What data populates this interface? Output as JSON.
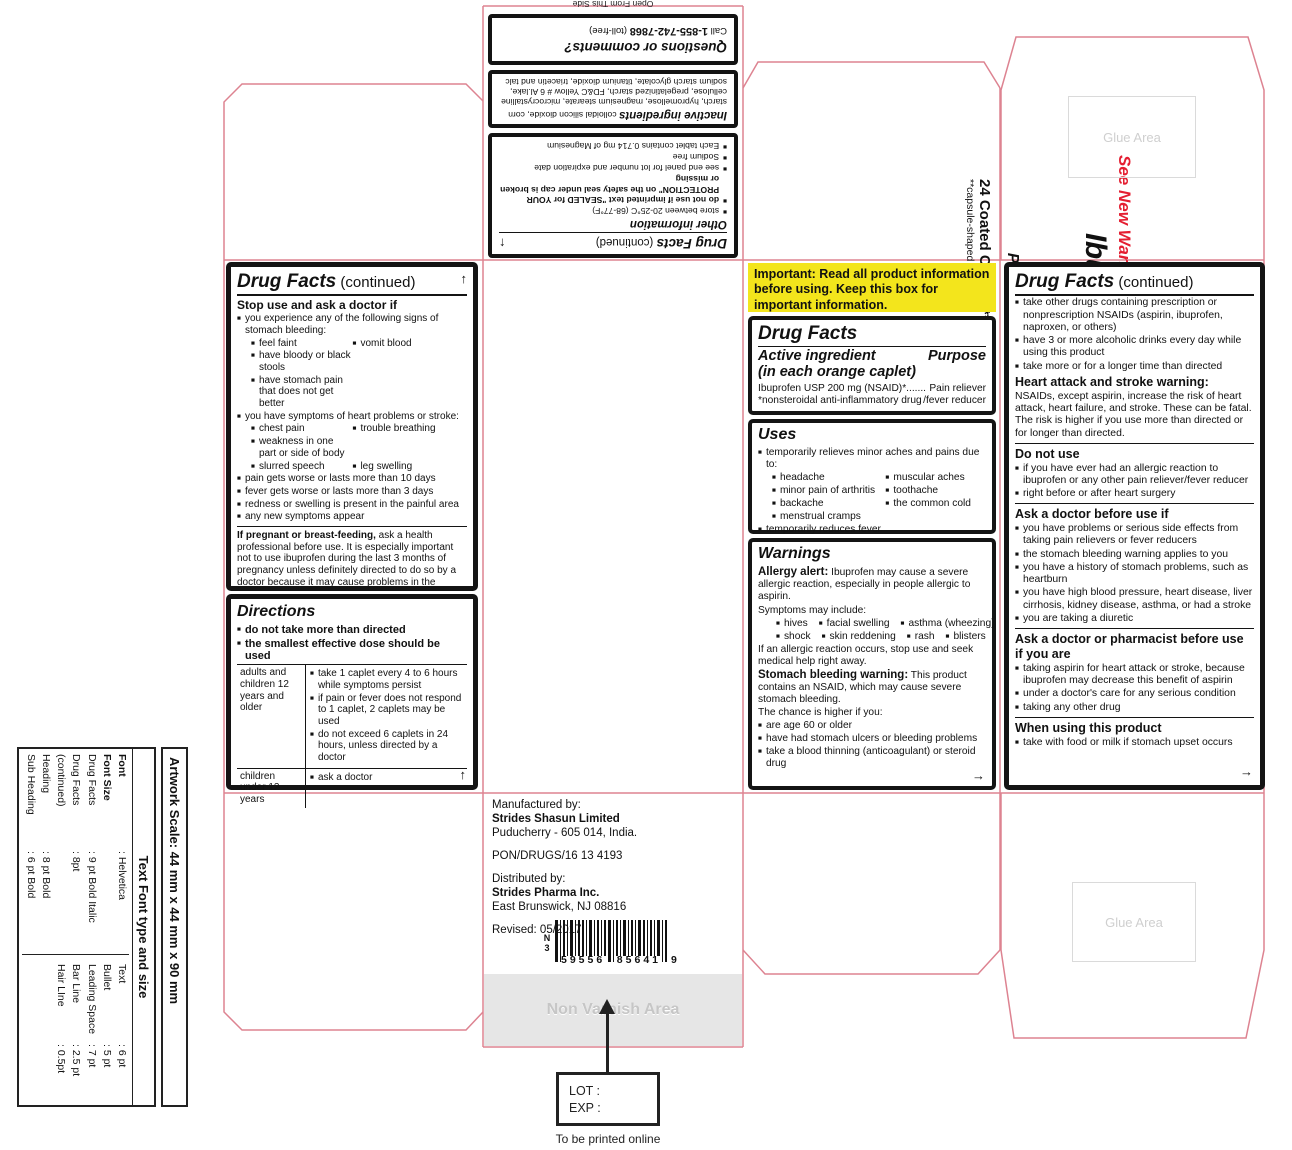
{
  "icons": {
    "up_arrow": "↑",
    "right_arrow": "→"
  },
  "colors": {
    "dieline": "#dd8391",
    "yellow": "#f3e51c",
    "orange": "#f08019",
    "red": "#e41e31"
  },
  "misc": {
    "open_from": "Open From This Side",
    "glue_area": "Glue Area",
    "non_varnish": "Non Varnish Area",
    "lot_label": "LOT :",
    "exp_label": "EXP :",
    "to_be_printed": "To be printed online"
  },
  "top_panel": {
    "dfc_title": "Drug Facts",
    "dfc_cont": " (continued)",
    "other_info": {
      "heading": "Other information",
      "rows": [
        {
          "t": "store between 20-25°C (68-77°F)"
        },
        {
          "b": "do not use if imprinted text \"SEALED for YOUR PROTECTION\" on the safety seal under cap is broken or missing"
        },
        {
          "t": "see end panel for lot number and expiration date"
        },
        {
          "t": "Sodium free"
        },
        {
          "t": "Each tablet contains 0.714 mg of Magnesium"
        }
      ]
    },
    "inactive": {
      "heading": "Inactive ingredients",
      "text": "colloidal silicon dioxide, corn starch, hypromellose, magnesium stearate, microcrystalline cellulose, pregelatinized starch, FD&C Yellow # 6 Al.lake, sodium starch glycolate, titanium dioxide, triacetin and talc"
    },
    "questions": {
      "heading": "Questions or comments?",
      "call_prefix": "Call ",
      "phone": "1-855-742-7868",
      "call_suffix": " (toll-free)"
    }
  },
  "left_panel": {
    "dfc_title": "Drug Facts",
    "dfc_cont": " (continued)",
    "stop_use": {
      "heading": "Stop use and ask a doctor if",
      "rows": [
        {
          "c": [
            {
              "t": "you experience any of the following signs of stomach bleeding:"
            }
          ]
        },
        {
          "i": 1,
          "c": [
            {
              "t": "feel faint"
            },
            {
              "t": "vomit blood"
            }
          ]
        },
        {
          "i": 1,
          "c": [
            {
              "t": "have bloody or black stools"
            }
          ]
        },
        {
          "i": 1,
          "c": [
            {
              "t": "have stomach pain that does not get better"
            }
          ]
        },
        {
          "c": [
            {
              "t": "you have symptoms of heart problems or stroke:"
            }
          ]
        },
        {
          "i": 1,
          "c": [
            {
              "t": "chest pain"
            },
            {
              "t": "trouble breathing"
            }
          ]
        },
        {
          "i": 1,
          "c": [
            {
              "t": "weakness in one part or side of body"
            }
          ]
        },
        {
          "i": 1,
          "c": [
            {
              "t": "slurred speech"
            },
            {
              "t": "leg swelling"
            }
          ]
        },
        {
          "c": [
            {
              "t": "pain gets worse or lasts more than 10 days"
            }
          ]
        },
        {
          "c": [
            {
              "t": "fever gets worse or lasts more than 3 days"
            }
          ]
        },
        {
          "c": [
            {
              "t": "redness or swelling is present in the painful area"
            }
          ]
        },
        {
          "c": [
            {
              "t": "any new symptoms appear"
            }
          ]
        }
      ]
    },
    "pregnant": {
      "b": "If pregnant or breast-feeding,",
      "t": " ask a health professional before use. It is especially important not to use ibuprofen during the last 3 months of pregnancy unless definitely directed to do so by a doctor because it may cause problems in the unborn child or complications during delivery."
    },
    "keep_out": {
      "heading": "Keep out of reach of children.",
      "text": "In case of overdose, get medical help or contact a Poison Control Center right away.(1-800-222-1222)"
    },
    "directions": {
      "heading": "Directions",
      "rows": [
        {
          "c": [
            {
              "b": "do not take more than directed"
            }
          ]
        },
        {
          "c": [
            {
              "b": "the smallest effective dose should be used"
            }
          ]
        }
      ],
      "table": [
        {
          "who": "adults and children 12 years and older",
          "items": [
            {
              "c": [
                {
                  "t": "take 1 caplet every 4 to 6 hours while symptoms persist"
                }
              ]
            },
            {
              "c": [
                {
                  "t": "if pain or fever does not respond to 1 caplet, 2 caplets may be used"
                }
              ]
            },
            {
              "c": [
                {
                  "t": "do not exceed 6 caplets in 24 hours, unless directed by a doctor"
                }
              ]
            }
          ]
        },
        {
          "who": "children under 12 years",
          "items": [
            {
              "c": [
                {
                  "t": "ask a doctor"
                }
              ]
            }
          ]
        }
      ]
    }
  },
  "brand_panel": {
    "see_new_warnings": "See New Warnings",
    "ndc": "NDC 59556-856-41",
    "title": "Ibuprofen Tablets, USP",
    "strength": "200 mg",
    "subtitle": "Pain Reliever/Fever Reducer (NSAID)*",
    "count": "24 Coated Caplets**",
    "count_note": "**capsule-shaped tablets",
    "footnote_line1": "*nonsteroidal",
    "footnote_line2": "anti-inflammatory drug"
  },
  "important_notice": "Important: Read all product information before using. Keep this box for important information.",
  "drug_facts_main": {
    "title": "Drug Facts",
    "active_heading": "Active ingredient",
    "active_sub": "(in each orange caplet)",
    "purpose": "Purpose",
    "ingredient": "Ibuprofen USP 200 mg (NSAID)*",
    "dots": ".......",
    "purpose_value": "Pain reliever",
    "note_left": "*nonsteroidal anti-inflammatory drug",
    "note_right": "/fever reducer"
  },
  "uses": {
    "heading": "Uses",
    "rows": [
      {
        "c": [
          {
            "t": "temporarily relieves minor aches and pains due to:"
          }
        ]
      },
      {
        "i": 1,
        "c": [
          {
            "t": "headache"
          },
          {
            "t": "muscular aches"
          }
        ]
      },
      {
        "i": 1,
        "c": [
          {
            "t": "minor pain of arthritis"
          },
          {
            "t": "toothache"
          }
        ]
      },
      {
        "i": 1,
        "c": [
          {
            "t": "backache"
          },
          {
            "t": "the common cold"
          }
        ]
      },
      {
        "i": 1,
        "c": [
          {
            "t": "menstrual cramps"
          }
        ]
      },
      {
        "c": [
          {
            "t": "temporarily reduces fever"
          }
        ]
      }
    ]
  },
  "warnings": {
    "heading": "Warnings",
    "allergy_b": "Allergy alert:",
    "allergy_t": " Ibuprofen may cause a severe allergic reaction, especially in people allergic to aspirin.",
    "symptoms_intro": "Symptoms may include:",
    "symptom_rows": [
      {
        "i": 1,
        "c": [
          {
            "t": "hives"
          },
          {
            "t": "facial swelling"
          },
          {
            "t": "asthma (wheezing)"
          }
        ]
      },
      {
        "i": 1,
        "c": [
          {
            "t": "shock"
          },
          {
            "t": "skin reddening"
          },
          {
            "t": "rash"
          },
          {
            "t": "blisters"
          }
        ]
      }
    ],
    "post_symptoms": "If an allergic reaction occurs, stop use and seek medical help right away.",
    "stomach_b": "Stomach bleeding warning:",
    "stomach_t": " This product contains an NSAID, which may cause severe stomach bleeding.",
    "chance": "The chance is higher if you:",
    "rows": [
      {
        "c": [
          {
            "t": "are age 60 or older"
          }
        ]
      },
      {
        "c": [
          {
            "t": "have had stomach ulcers or bleeding problems"
          }
        ]
      },
      {
        "c": [
          {
            "t": "take a blood thinning (anticoagulant) or steroid drug"
          }
        ]
      }
    ]
  },
  "right_panel": {
    "dfc_title": "Drug Facts",
    "dfc_cont": " (continued)",
    "cont_rows": [
      {
        "c": [
          {
            "t": "take other drugs containing prescription or nonprescription NSAIDs (aspirin, ibuprofen, naproxen, or others)"
          }
        ]
      },
      {
        "c": [
          {
            "t": "have 3 or more alcoholic drinks every day while using this product"
          }
        ]
      },
      {
        "c": [
          {
            "t": "take more or for a longer time than directed"
          }
        ]
      }
    ],
    "heart_heading": "Heart attack and stroke warning:",
    "heart_text": "NSAIDs, except aspirin, increase the risk of heart attack, heart failure, and stroke. These can be fatal. The risk is higher if you use more than directed or for longer than directed.",
    "do_not_use": {
      "heading": "Do not use",
      "rows": [
        {
          "c": [
            {
              "t": "if you have ever had an allergic reaction to ibuprofen or any other pain reliever/fever reducer"
            }
          ]
        },
        {
          "c": [
            {
              "t": "right before or after heart surgery"
            }
          ]
        }
      ]
    },
    "ask_doctor": {
      "heading": "Ask a doctor before use if",
      "rows": [
        {
          "c": [
            {
              "t": "you have problems or serious side effects from taking pain relievers or fever reducers"
            }
          ]
        },
        {
          "c": [
            {
              "t": "the stomach bleeding warning applies to you"
            }
          ]
        },
        {
          "c": [
            {
              "t": "you have a history of stomach problems, such as heartburn"
            }
          ]
        },
        {
          "c": [
            {
              "t": "you have high blood pressure, heart disease, liver cirrhosis, kidney disease, asthma, or had a stroke"
            }
          ]
        },
        {
          "c": [
            {
              "t": "you are taking a diuretic"
            }
          ]
        }
      ]
    },
    "ask_pharmacist": {
      "heading": "Ask a doctor or pharmacist before use if you are",
      "rows": [
        {
          "c": [
            {
              "t": "taking aspirin for heart attack or stroke, because ibuprofen may decrease this benefit of aspirin"
            }
          ]
        },
        {
          "c": [
            {
              "t": "under a doctor's care for any serious condition"
            }
          ]
        },
        {
          "c": [
            {
              "t": "taking any other drug"
            }
          ]
        }
      ]
    },
    "when_using": {
      "heading": "When using this product",
      "rows": [
        {
          "c": [
            {
              "t": "take with food or milk if stomach upset occurs"
            }
          ]
        }
      ]
    }
  },
  "manufacturer": {
    "lines": [
      {
        "t": "Manufactured by:"
      },
      {
        "t": "Strides Shasun Limited",
        "b": 1
      },
      {
        "t": "Puducherry - 605 014, India.",
        "gap": 1
      },
      {
        "t": "PON/DRUGS/16 13 4193",
        "gap": 1
      },
      {
        "t": "Distributed by:"
      },
      {
        "t": "Strides Pharma Inc.",
        "b": 1
      },
      {
        "t": "East Brunswick, NJ 08816",
        "gap": 1
      },
      {
        "t": "Revised: 05/2017"
      }
    ]
  },
  "barcode": {
    "n": "N",
    "d0": "3",
    "d1": "59556",
    "d2": "85641",
    "d3": "9"
  },
  "sidebar": {
    "scale": "Artwork Scale:  44 mm x 44 mm x 90 mm",
    "header": "Text Font type and size",
    "left_rows": [
      {
        "k": "Font",
        "v": ": Helvetica",
        "b": 1
      },
      {
        "k": "Font Size",
        "v": "",
        "b": 1
      },
      {
        "k": "Drug Facts",
        "v": ": 9 pt Bold Italic"
      },
      {
        "k": "Drug Facts (continued)",
        "v": ": 8pt"
      },
      {
        "k": "Heading",
        "v": ": 8 pt Bold"
      },
      {
        "k": "Sub Heading",
        "v": ": 6 pt Bold"
      }
    ],
    "right_rows": [
      {
        "k": "Text",
        "v": ": 6 pt"
      },
      {
        "k": "Bullet",
        "v": ": 5 pt"
      },
      {
        "k": "Leading Space",
        "v": ": 7 pt"
      },
      {
        "k": "Bar Line",
        "v": ": 2.5 pt"
      },
      {
        "k": "Hair LIne",
        "v": ": 0.5pt"
      }
    ]
  }
}
